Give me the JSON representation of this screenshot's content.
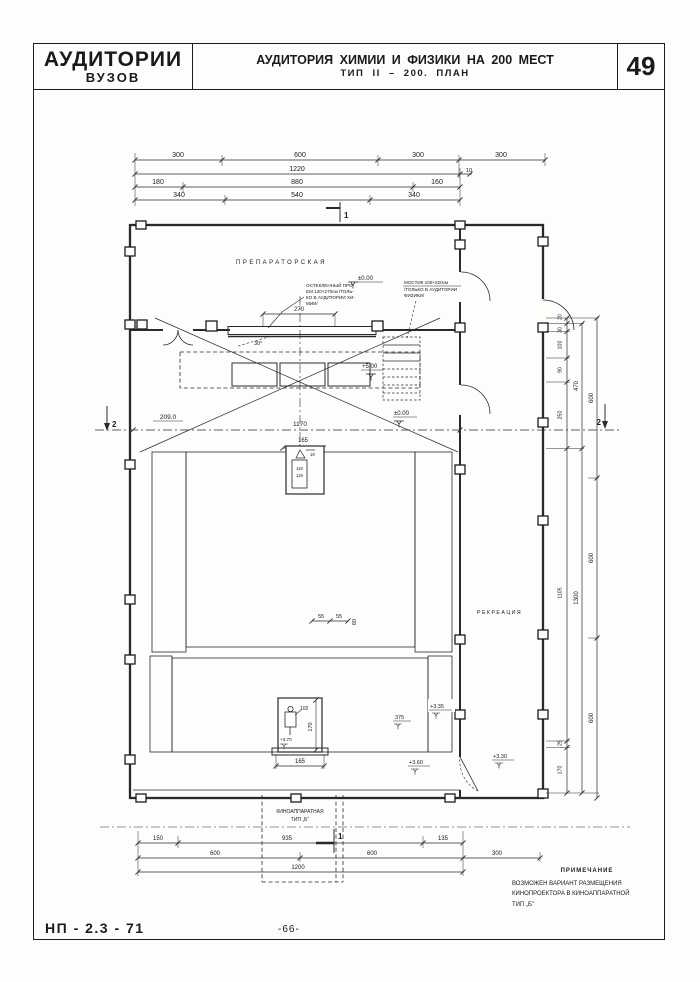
{
  "header": {
    "series_line1": "АУДИТОРИИ",
    "series_line2": "ВУЗОВ",
    "title_line1": "АУДИТОРИЯ  ХИМИИ  И  ФИЗИКИ  НА 200 МЕСТ",
    "title_line2": "ТИП  II – 200.    ПЛАН",
    "sheet_number": "49"
  },
  "footer": {
    "doc_code": "НП - 2.3 - 71",
    "page_number": "-66-"
  },
  "note": {
    "title": "ПРИМЕЧАНИЕ",
    "line1": "ВОЗМОЖЕН  ВАРИАНТ  РАЗМЕЩЕНИЯ",
    "line2": "КИНОПРОЕКТОРА  В  КИНОАППАРАТНОЙ",
    "line3": "ТИП „Б”"
  },
  "rooms": {
    "prep": "ПРЕПАРАТОРСКАЯ",
    "recreation": "РЕКРЕАЦИЯ",
    "cinema1": "КИНОАППАРАТНАЯ",
    "cinema2": "ТИП „Б”"
  },
  "ann": {
    "glass1": "ОСТЕКЛЕННЫЙ ПРО-",
    "glass2": "ЕМ 120×270см /ТОЛЬ-",
    "glass3": "КО В АУДИТОРИИ ХИ-",
    "glass4": "МИИ/",
    "bridge1": "МОСТИК 100×220см",
    "bridge2": "/ТОЛЬКО В АУДИТОРИИ",
    "bridge3": "ФИЗИКИ/",
    "angle": "30°",
    "eq_a": "19",
    "eq_b": "118",
    "eq_c": "119"
  },
  "lv": {
    "zero_top": "±0.00",
    "zero_mid": "±0.00",
    "p500": "+5.00",
    "p370": "+3.70",
    "p375": "375",
    "p335": "+3.35",
    "p330": "+3.30",
    "p360": "+3.60"
  },
  "dims": {
    "t1a": "300",
    "t1b": "600",
    "t1c": "300",
    "t1d": "300",
    "t2": "1220",
    "t2b": "10",
    "t3a": "180",
    "t3b": "880",
    "t3c": "160",
    "t4a": "340",
    "t4b": "540",
    "t4c": "340",
    "d270": "270",
    "d2090": "209.0",
    "d1170": "1170",
    "d165": "165",
    "s55a": "55",
    "s55b": "55",
    "s60": "60",
    "d102": "102",
    "d170v": "170",
    "d165b": "165",
    "r20": "20",
    "r30": "30",
    "r100": "100",
    "r90": "90",
    "r250": "250",
    "r1105": "1105",
    "r25": "25",
    "r170": "170",
    "r470": "470",
    "r1300": "1300",
    "r600a": "600",
    "r600b": "600",
    "r600c": "600",
    "b150": "150",
    "b935": "935",
    "b135": "135",
    "b600a": "600",
    "b600b": "600",
    "b300": "300",
    "b1200": "1200"
  },
  "sections": {
    "s1": "1",
    "s1b": "1",
    "s2a": "2",
    "s2b": "2"
  }
}
